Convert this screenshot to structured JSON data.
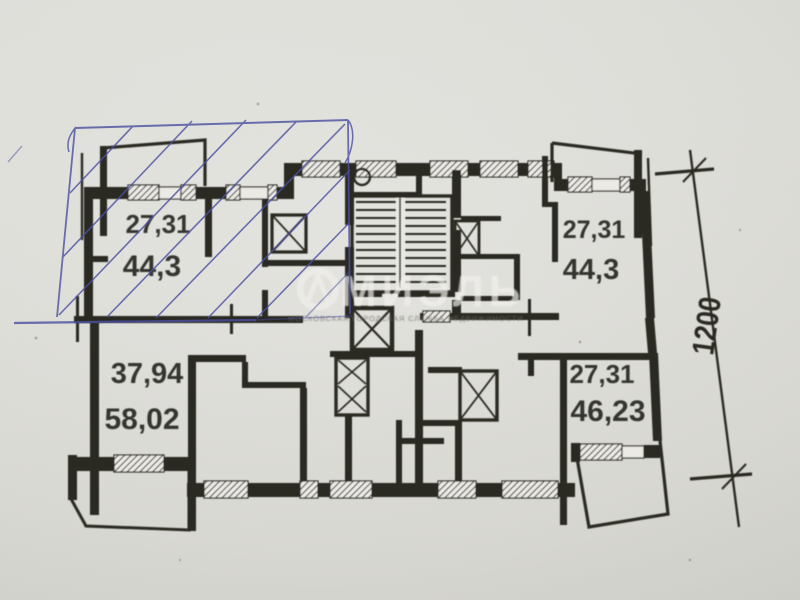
{
  "document": {
    "kind": "scanned apartment floor plan photo",
    "sections": "two half-floor sections separated by a match line"
  },
  "colors": {
    "paper": "#dcdcd7",
    "ink": "#2b2924",
    "pen_blue": "#4b50a0",
    "watermark": "#f2f1ec"
  },
  "apartments": [
    {
      "name": "top-left",
      "living_area": "27,31",
      "total_area": "44,3"
    },
    {
      "name": "top-right",
      "living_area": "27,31",
      "total_area": "44,3"
    },
    {
      "name": "bottom-left",
      "living_area": "37,94",
      "total_area": "58,02"
    },
    {
      "name": "bottom-right",
      "living_area": "27,31",
      "total_area": "46,23"
    }
  ],
  "dimension": {
    "vertical_right": "1200"
  },
  "watermark": {
    "brand": "МИЭЛЬ",
    "tagline": "МОСКОВСКАЯ ГОРОДСКАЯ СЛУЖБА НЕДВИЖИМОСТИ"
  },
  "annotation": {
    "type": "blue pen highlight with diagonal hatching over top-left apartment"
  }
}
